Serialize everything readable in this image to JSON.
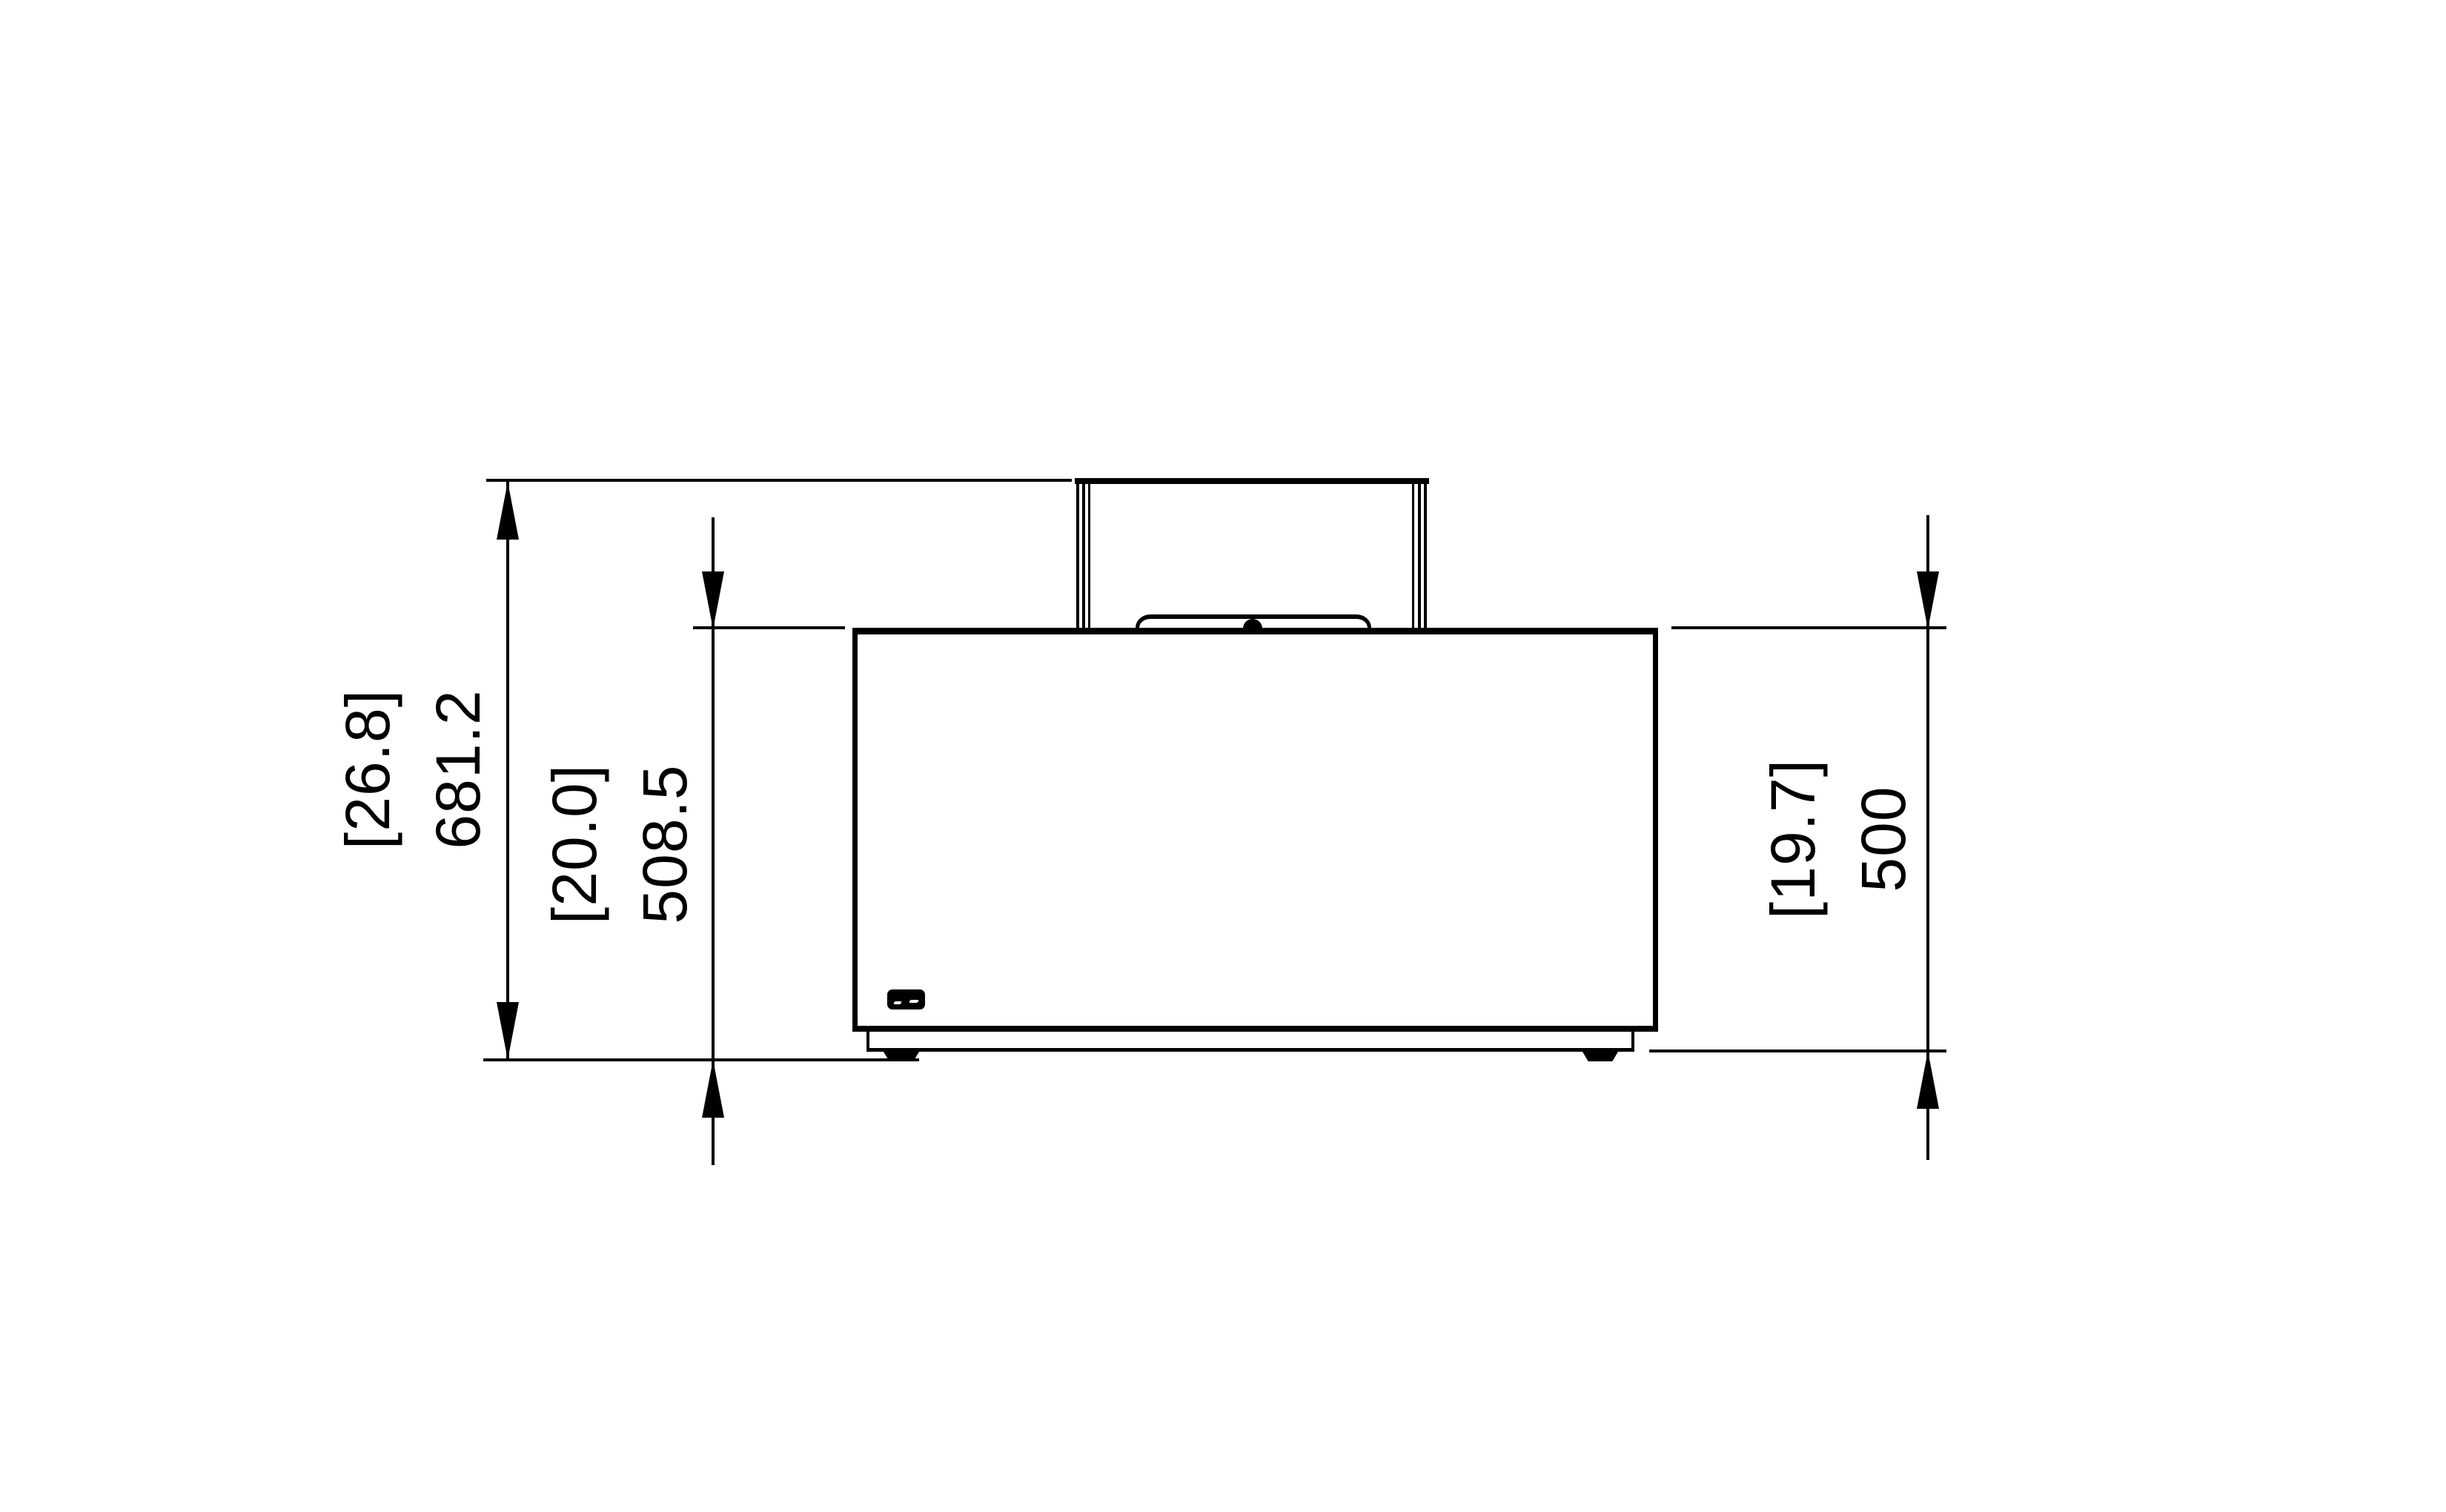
{
  "palette": {
    "ink": "#000000",
    "paper": "#ffffff"
  },
  "dimensions": {
    "overall_height": {
      "inches": "[26.8]",
      "mm": "681.2"
    },
    "height_incl_feet": {
      "inches": "[20.0]",
      "mm": "508.5"
    },
    "body_height": {
      "inches": "[19.7]",
      "mm": "500"
    }
  }
}
